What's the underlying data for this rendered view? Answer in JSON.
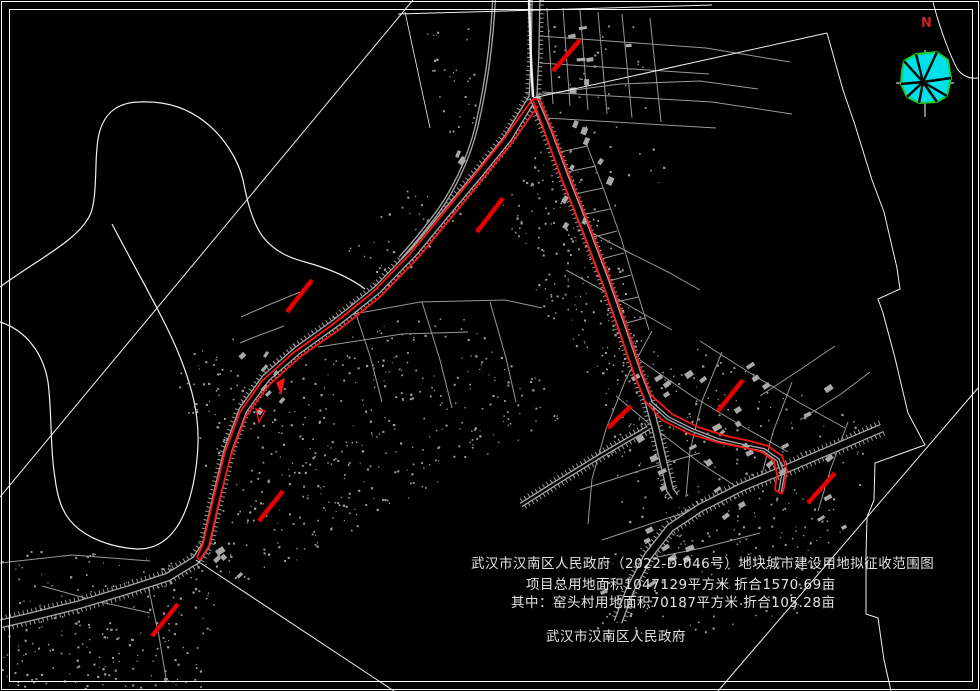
{
  "annotation": {
    "line1": "武汉市汉南区人民政府（2022-D-046号）地块城市建设用地拟征收范围图",
    "line2": "项目总用地面积1047129平方米 折合1570.69亩",
    "line3": "其中：窑头村用地面积70187平方米 折合105.28亩",
    "line4": "武汉市汉南区人民政府"
  },
  "compass": {
    "label": "N"
  },
  "colors": {
    "background": "#000000",
    "border": "#ffffff",
    "boundary_white": "#f0f0f0",
    "road_gray": "#a5a5a5",
    "tick_gray": "#9b9b9b",
    "dot_gray": "#9d9d9d",
    "building_gray": "#a8a8a8",
    "red_line": "#ff1414",
    "red_tick": "#e60000",
    "compass_fill": "#00e0e8",
    "compass_outline": "#1ecc28",
    "north_label": "#cc2222"
  },
  "map": {
    "width": 980,
    "height": 691,
    "borders": [
      {
        "x": 1.5,
        "y": 1.5,
        "w": 977,
        "h": 688
      },
      {
        "x": 9.5,
        "y": 9.5,
        "w": 963,
        "h": 672
      }
    ],
    "white_paths": [
      {
        "d": "M 0,287 C 40,258 78,240 90,215 C 97,200 95,165 97,148 C 99,116 115,102 140,102 C 163,101 185,106 205,122 C 222,135 238,158 243,180 C 247,200 252,222 263,237 C 275,252 290,258 305,262 C 327,268 348,276 365,289",
        "w": 1.2
      },
      {
        "d": "M 0,322 C 25,330 43,352 48,382 C 52,412 50,448 55,478 C 58,502 64,518 80,530 C 96,542 118,548 138,549 C 158,549 172,538 182,518 C 192,498 197,470 198,444 C 199,414 192,386 178,352 C 164,318 136,270 112,224",
        "w": 1.2
      },
      {
        "d": "M 413,0 L 0,497",
        "w": 1
      },
      {
        "d": "M 398,14 L 712,5",
        "w": 1
      },
      {
        "d": "M 533,98 L 827,33",
        "w": 1
      },
      {
        "d": "M 827,33 L 843,90 L 855,125 L 872,180 L 884,212 L 897,268 L 900,289 L 878,299 L 883,313 L 895,358 L 908,413 L 925,445 L 875,463 L 874,500 L 867,517 L 866,556 L 866,614 L 878,618 L 884,660 L 891,691",
        "w": 1
      },
      {
        "d": "M 978,388 L 718,691",
        "w": 1
      },
      {
        "d": "M 196,560 L 394,691",
        "w": 1
      },
      {
        "d": "M 933,2 C 940,30 952,60 958,70 C 963,76 970,79 978,78",
        "w": 1
      },
      {
        "d": "M 529,0 L 531,60 L 533,97",
        "w": 2.5
      },
      {
        "d": "M 405,12 L 430,128",
        "w": 0.8
      }
    ],
    "roads": [
      {
        "d": "M 536,0 L 535,55 L 533,97 L 508,138 L 478,175 L 447,212 L 414,252 L 377,290 L 337,322 L 298,350 L 266,378 L 243,410 L 228,450 L 216,500 L 206,545 L 196,560 L 168,577 L 128,590 L 78,605 L 30,617 L 0,624",
        "w": 9,
        "hatch": true
      },
      {
        "d": "M 533,97 L 548,132 L 566,180 L 586,230 L 605,280 L 622,328 L 638,375 L 648,400 L 656,430 L 663,460 L 670,490 L 675,497",
        "w": 8,
        "hatch": true
      },
      {
        "d": "M 882,428 L 835,448 L 788,468 L 742,487 L 700,508 L 670,528 L 648,556 L 630,590 L 618,622",
        "w": 9,
        "hatch": true
      },
      {
        "d": "M 494,0 C 492,40 487,80 478,120 C 470,158 452,195 430,222 C 420,235 410,247 400,258",
        "w": 4,
        "hatch": false
      },
      {
        "d": "M 650,402 L 668,418 L 692,430 L 718,440 L 744,446 L 764,450 L 778,460 L 783,475 L 780,492",
        "w": 4,
        "hatch": false
      },
      {
        "d": "M 648,428 L 600,456 L 556,483 L 521,505",
        "w": 5,
        "hatch": true
      }
    ],
    "minor_lines": [
      "M547,8 L553,104",
      "M563,8 L570,106",
      "M580,10 L588,110",
      "M598,12 L607,114",
      "M622,14 L632,118",
      "M650,18 L661,122",
      "M540,36 L706,48",
      "M540,63 L709,74",
      "M542,92 L712,102",
      "M546,118 L716,128",
      "M706,48 L790,62",
      "M712,102 L792,114",
      "M585,140 L604,190 L621,238 L636,288 L649,330",
      "M560,152 L588,146",
      "M567,172 L596,166",
      "M575,194 L603,188",
      "M582,215 L610,209",
      "M590,238 L617,231",
      "M597,260 L624,253",
      "M605,282 L631,275",
      "M612,303 L638,297",
      "M619,325 L645,318",
      "M332,318 L420,302 L505,300 L542,308",
      "M318,347 L402,334 L468,332",
      "M352,302 L370,356 L382,402",
      "M422,302 L440,360 L452,408",
      "M490,302 L506,358 L516,402",
      "M300,292 L266,306 L241,317",
      "M284,326 L252,338 L240,343",
      "M583,228 L628,252 L668,272 L700,290",
      "M566,270 L604,291 L642,313 L672,330",
      "M640,360 L692,396 L742,426 L788,452",
      "M700,341 L750,373 L800,403 L845,428",
      "M616,396 L658,431 L700,463 L740,489",
      "M652,331 L626,379 L606,429 L592,479 L588,524",
      "M722,352 L702,401 L690,451 L686,497",
      "M792,382 L773,432 L761,478",
      "M848,422 L831,468 L818,511",
      "M580,490 L642,470 L700,453",
      "M602,540 L662,520 L722,501",
      "M638,561 L702,548 L760,533",
      "M800,420 L841,394 L870,372",
      "M760,396 L801,369 L835,346",
      "M0,563 L72,555 L150,561",
      "M148,586 L159,636 L166,679",
      "M42,586 L96,601 L150,613",
      "M536,95 L620,84 L700,81 L758,89"
    ],
    "red": {
      "corridors": [
        "M 529,104 L 503,140 L 473,177 L 442,215 L 409,255 L 372,293 L 332,325 L 293,353 L 262,381 L 240,412 L 225,452 L 213,500 L 203,544 L 197,557",
        "M 538,106 L 511,144 L 481,181 L 450,219 L 417,259 L 380,297 L 340,329 L 300,357 L 268,386 L 246,416 L 231,455 L 219,502 L 209,546 L 200,560",
        "M 529,104 L 533,99 L 540,100",
        "M 533,100 L 545,133 L 562,180 L 582,230 L 601,280 L 618,328 L 634,374 L 644,398",
        "M 540,100 L 552,130 L 570,177 L 590,227 L 609,277 L 626,325 L 641,370 L 651,395",
        "M 651,395 L 672,414 L 698,427 L 726,436 L 750,441 L 768,446 L 782,456 L 787,470 L 784,488 L 782,494",
        "M 644,400 L 662,420 L 690,434 L 720,443 L 746,448 L 762,452 L 774,461 L 777,474 L 775,490",
        "M 775,490 L 782,494",
        "M 197,557 L 200,560"
      ],
      "ticks": [
        [
          580,
          40,
          553,
          71
        ],
        [
          503,
          198,
          477,
          232
        ],
        [
          312,
          280,
          287,
          312
        ],
        [
          283,
          491,
          259,
          521
        ],
        [
          178,
          604,
          152,
          636
        ],
        [
          631,
          406,
          608,
          428
        ],
        [
          743,
          380,
          718,
          411
        ],
        [
          835,
          473,
          808,
          503
        ]
      ],
      "markers": [
        {
          "pts": [
            [
              277,
              383
            ],
            [
              284,
              379
            ],
            [
              281,
              393
            ]
          ],
          "fill": true
        },
        {
          "pts": [
            [
              256,
              409
            ],
            [
              265,
              411
            ],
            [
              259,
              422
            ]
          ],
          "fill": false
        }
      ]
    },
    "dot_regions": [
      {
        "poly": [
          [
            540,
            145
          ],
          [
            610,
            310
          ],
          [
            635,
            385
          ],
          [
            598,
            400
          ],
          [
            520,
            270
          ],
          [
            498,
            205
          ]
        ],
        "count": 130,
        "seed": 1
      },
      {
        "poly": [
          [
            565,
            135
          ],
          [
            640,
            310
          ],
          [
            660,
            360
          ],
          [
            700,
            380
          ],
          [
            660,
            395
          ],
          [
            610,
            330
          ],
          [
            556,
            170
          ]
        ],
        "count": 80,
        "seed": 2
      },
      {
        "poly": [
          [
            205,
            560
          ],
          [
            243,
            435
          ],
          [
            300,
            365
          ],
          [
            385,
            318
          ],
          [
            470,
            318
          ],
          [
            540,
            372
          ],
          [
            560,
            420
          ],
          [
            440,
            480
          ],
          [
            310,
            555
          ],
          [
            240,
            585
          ]
        ],
        "count": 380,
        "seed": 3
      },
      {
        "poly": [
          [
            0,
            545
          ],
          [
            225,
            565
          ],
          [
            205,
            688
          ],
          [
            0,
            688
          ]
        ],
        "count": 230,
        "seed": 4
      },
      {
        "poly": [
          [
            600,
            360
          ],
          [
            700,
            348
          ],
          [
            862,
            420
          ],
          [
            868,
            470
          ],
          [
            835,
            556
          ],
          [
            640,
            556
          ],
          [
            608,
            470
          ]
        ],
        "count": 220,
        "seed": 5
      },
      {
        "poly": [
          [
            545,
            25
          ],
          [
            640,
            25
          ],
          [
            665,
            175
          ],
          [
            628,
            228
          ],
          [
            560,
            115
          ]
        ],
        "count": 45,
        "seed": 6
      },
      {
        "poly": [
          [
            172,
            362
          ],
          [
            232,
            330
          ],
          [
            256,
            420
          ],
          [
            203,
            478
          ]
        ],
        "count": 60,
        "seed": 7
      },
      {
        "poly": [
          [
            345,
            248
          ],
          [
            415,
            182
          ],
          [
            465,
            215
          ],
          [
            375,
            300
          ]
        ],
        "count": 45,
        "seed": 8
      },
      {
        "poly": [
          [
            560,
            565
          ],
          [
            745,
            518
          ],
          [
            845,
            520
          ],
          [
            795,
            625
          ],
          [
            600,
            640
          ]
        ],
        "count": 120,
        "seed": 9
      },
      {
        "poly": [
          [
            425,
            30
          ],
          [
            470,
            25
          ],
          [
            480,
            120
          ],
          [
            440,
            140
          ]
        ],
        "count": 30,
        "seed": 10
      }
    ],
    "building_clusters": [
      {
        "x": 625,
        "y": 365,
        "w": 235,
        "h": 165,
        "count": 34,
        "seed": 11,
        "rot": -32
      },
      {
        "x": 560,
        "y": 125,
        "w": 70,
        "h": 110,
        "count": 9,
        "seed": 12,
        "rot": -62
      },
      {
        "x": 238,
        "y": 350,
        "w": 62,
        "h": 68,
        "count": 8,
        "seed": 13,
        "rot": -48
      },
      {
        "x": 548,
        "y": 22,
        "w": 85,
        "h": 85,
        "count": 7,
        "seed": 14,
        "rot": -5
      },
      {
        "x": 200,
        "y": 548,
        "w": 55,
        "h": 30,
        "count": 4,
        "seed": 15,
        "rot": -40
      },
      {
        "x": 598,
        "y": 540,
        "w": 100,
        "h": 55,
        "count": 7,
        "seed": 16,
        "rot": -28
      },
      {
        "x": 428,
        "y": 145,
        "w": 40,
        "h": 60,
        "count": 4,
        "seed": 17,
        "rot": -60
      }
    ],
    "compass": {
      "cx": 925,
      "cy": 82,
      "cross_v": [
        925,
        50,
        925,
        117
      ],
      "cross_h": [
        896,
        83,
        954,
        83
      ],
      "fan": [
        [
          904,
          61
        ],
        [
          916,
          54
        ],
        [
          937,
          52
        ],
        [
          948,
          60
        ],
        [
          951,
          78
        ],
        [
          947,
          96
        ],
        [
          937,
          102
        ],
        [
          919,
          103
        ],
        [
          907,
          97
        ],
        [
          901,
          84
        ],
        [
          902,
          71
        ]
      ],
      "ray_center": [
        923,
        82
      ],
      "ray_tips": [
        [
          904,
          61
        ],
        [
          916,
          54
        ],
        [
          937,
          52
        ],
        [
          951,
          78
        ],
        [
          947,
          96
        ],
        [
          937,
          102
        ],
        [
          919,
          103
        ],
        [
          907,
          97
        ],
        [
          901,
          84
        ]
      ],
      "label_x": 921,
      "label_y": 27
    }
  }
}
